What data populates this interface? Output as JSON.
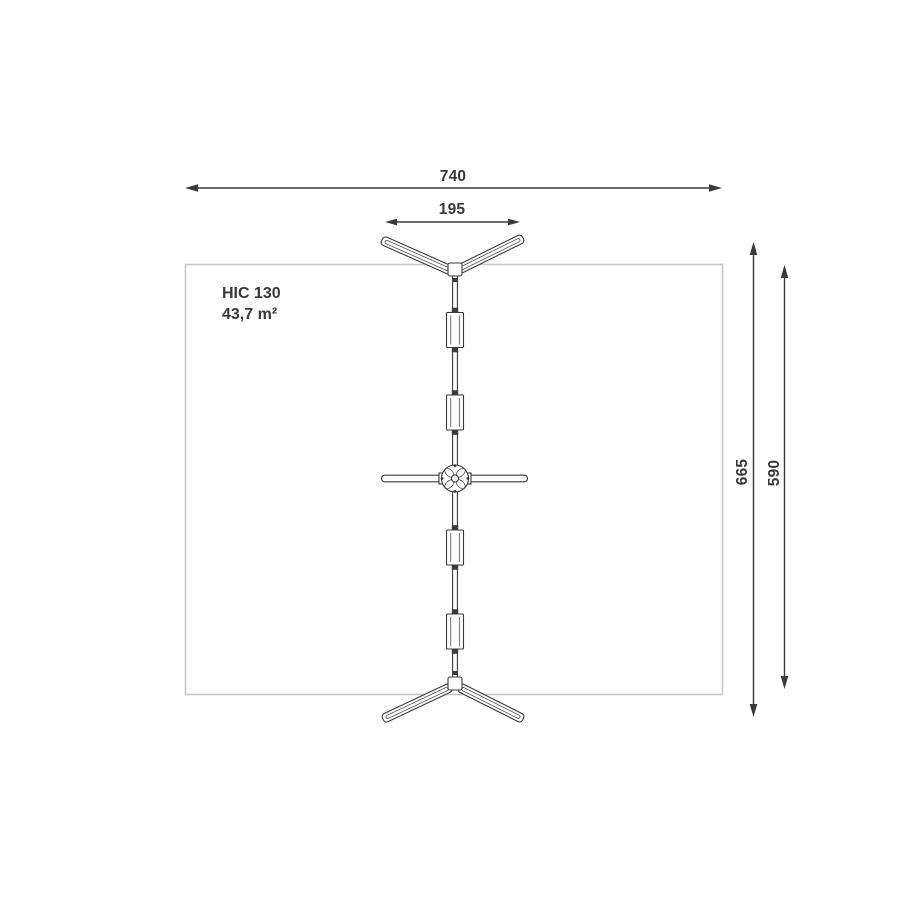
{
  "colors": {
    "background": "#ffffff",
    "line_work": "#3b3b3b",
    "dimension_lines": "#3a3a3a",
    "safety_zone_border": "#c8c8c8",
    "text": "#383838"
  },
  "safety_zone": {
    "hic_label": "HIC 130",
    "area_label": "43,7 m²"
  },
  "dimensions": {
    "total_width": "740",
    "top_arms_span": "195",
    "overall_height": "665",
    "safety_zone_height": "590"
  }
}
